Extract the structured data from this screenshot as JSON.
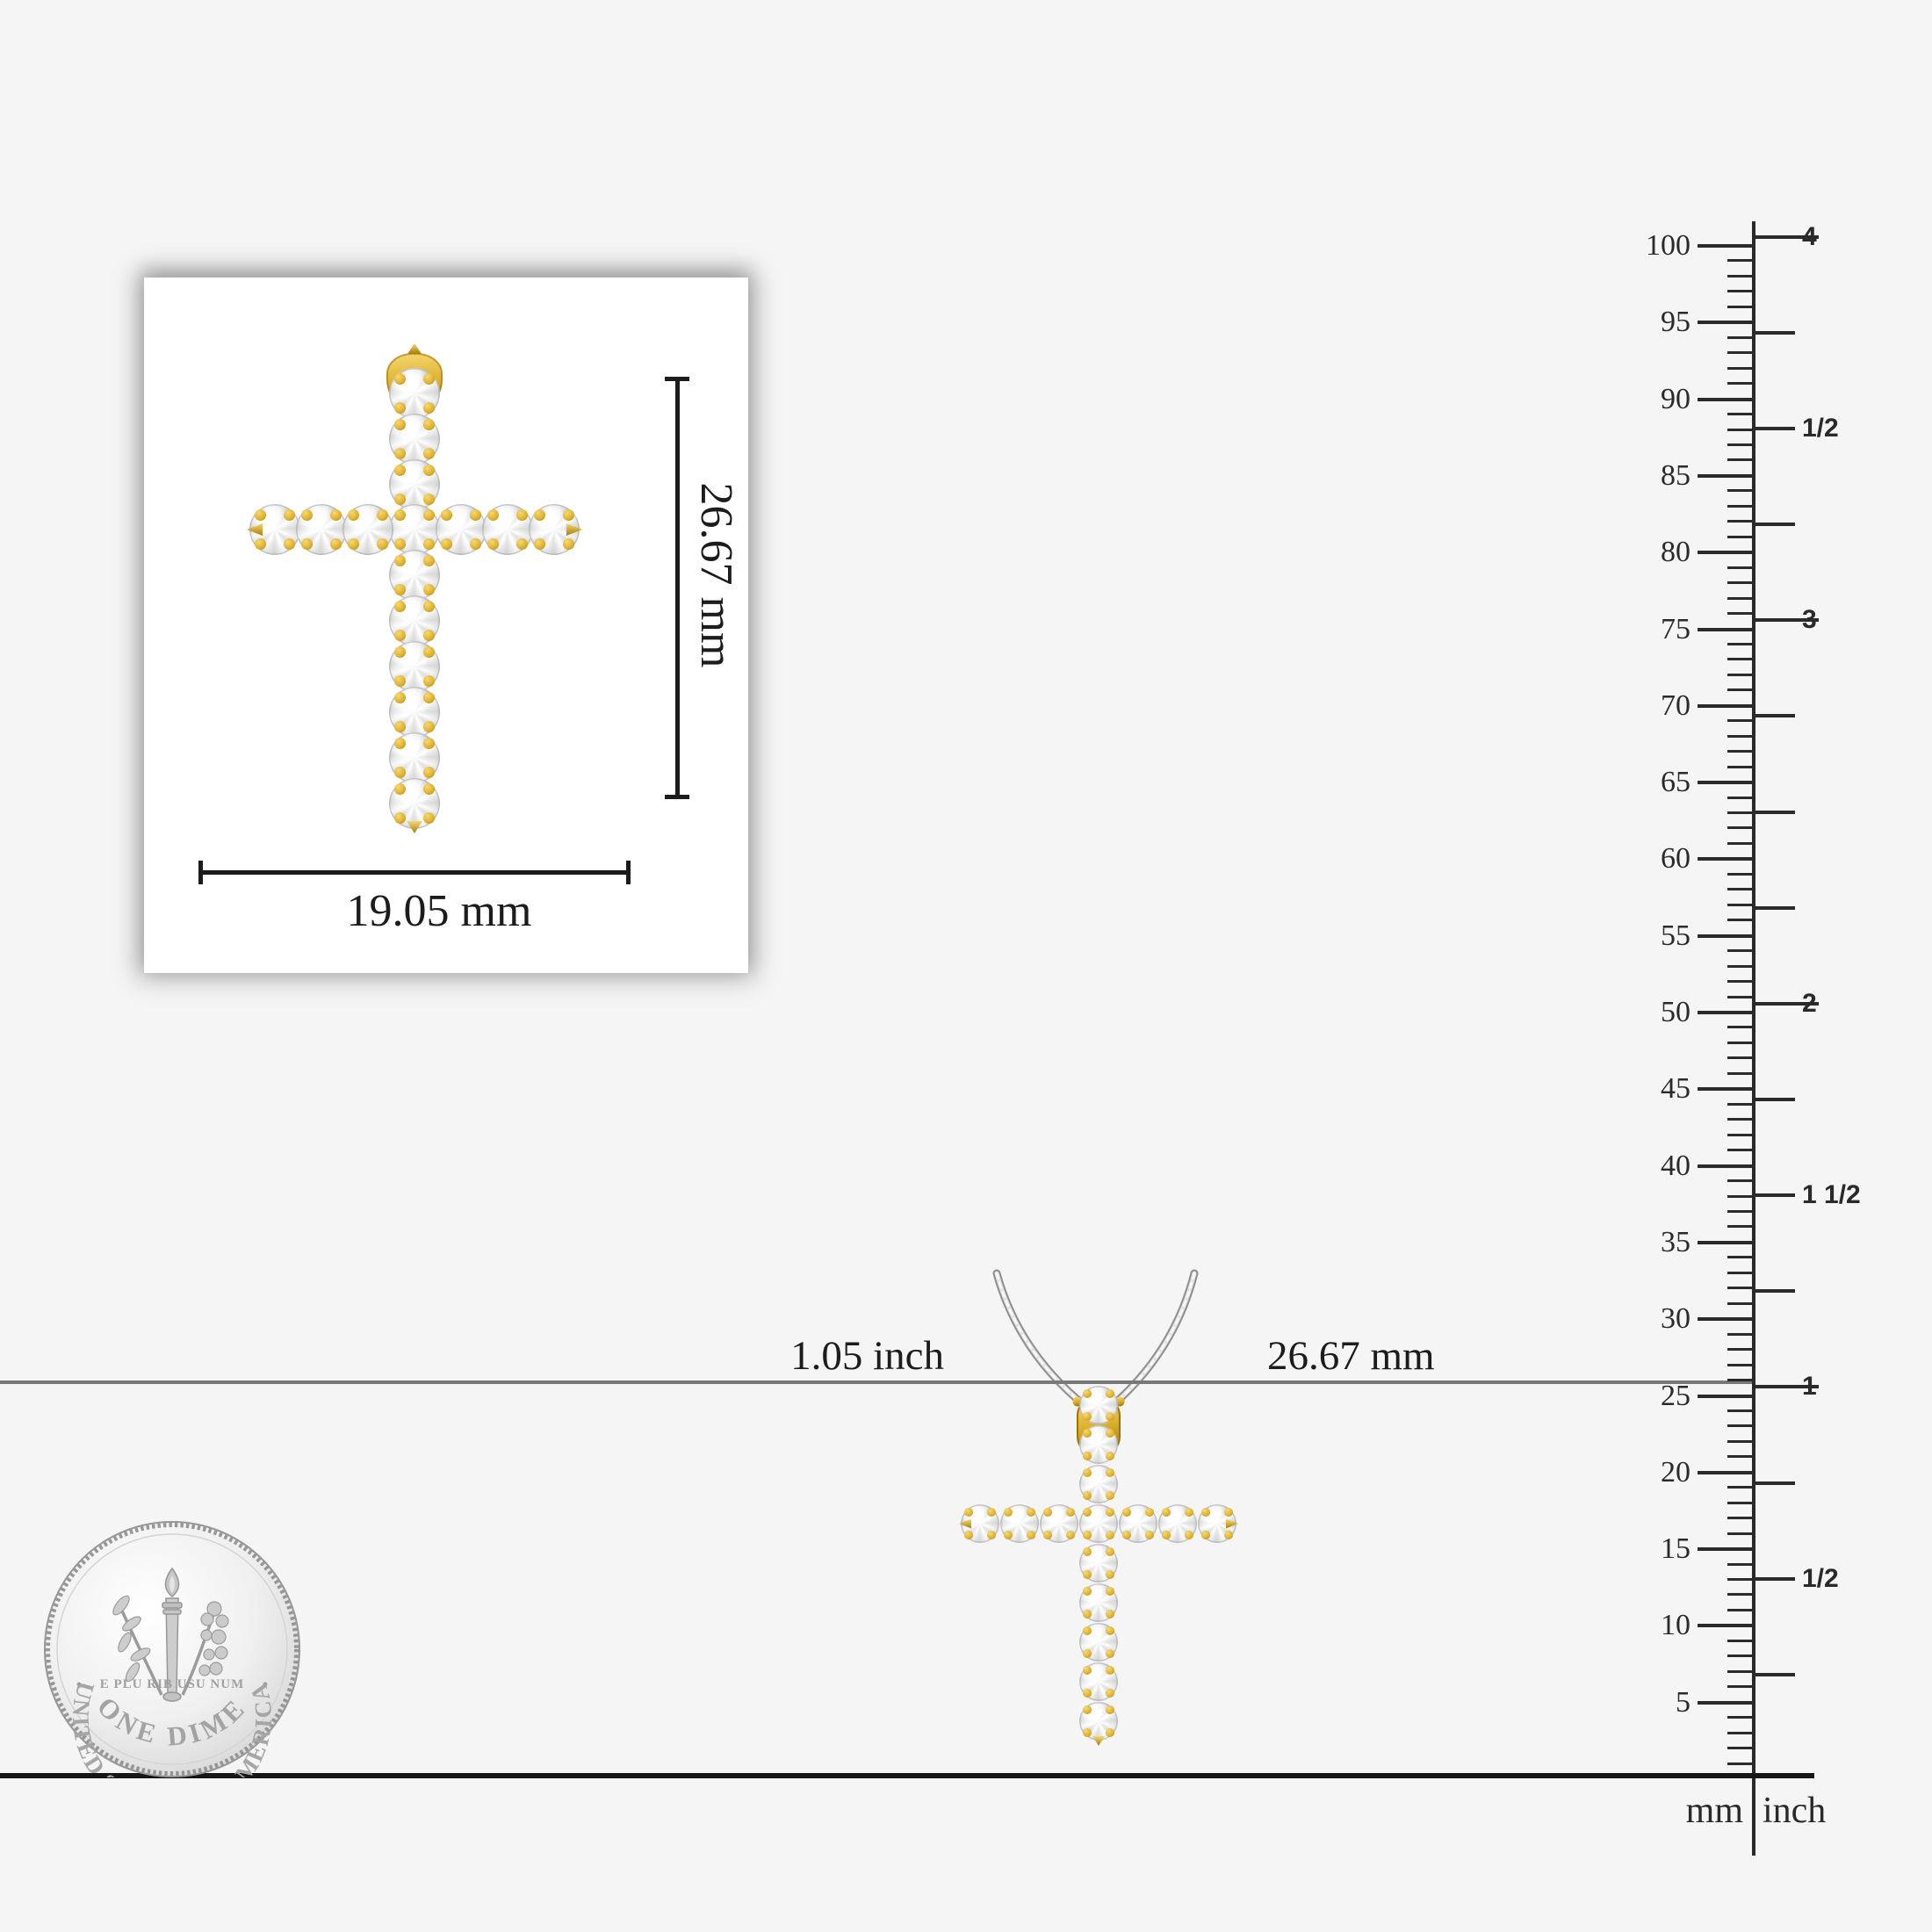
{
  "colors": {
    "background": "#f5f5f5",
    "card": "#ffffff",
    "gold": "#ddb12e",
    "gold_light": "#f6d873",
    "gold_dark": "#a87d08",
    "silver_chain": "#9a9a9a",
    "ink": "#1c1c1c",
    "mid_line": "#787878",
    "ruler_ink": "#2a2a2a"
  },
  "card": {
    "height_label": "26.67 mm",
    "width_label": "19.05 mm"
  },
  "scale_line": {
    "left_label": "1.05 inch",
    "right_label": "26.67 mm"
  },
  "ruler": {
    "unit_left": "mm",
    "unit_right": "inch",
    "mm_major_values": [
      100,
      95,
      90,
      85,
      80,
      75,
      70,
      65,
      60,
      55,
      50,
      45,
      40,
      35,
      30,
      25,
      20,
      15,
      10,
      5
    ],
    "inch_marks": [
      {
        "value": 4,
        "label": "4"
      },
      {
        "value": 3.75,
        "label": ""
      },
      {
        "value": 3.5,
        "label": "1/2"
      },
      {
        "value": 3.25,
        "label": ""
      },
      {
        "value": 3,
        "label": "3"
      },
      {
        "value": 2.75,
        "label": ""
      },
      {
        "value": 2.5,
        "label": ""
      },
      {
        "value": 2.25,
        "label": ""
      },
      {
        "value": 2,
        "label": "2"
      },
      {
        "value": 1.75,
        "label": ""
      },
      {
        "value": 1.5,
        "label": "1 1/2"
      },
      {
        "value": 1.25,
        "label": ""
      },
      {
        "value": 1,
        "label": "1"
      },
      {
        "value": 0.75,
        "label": ""
      },
      {
        "value": 0.5,
        "label": "1/2"
      },
      {
        "value": 0.25,
        "label": ""
      }
    ]
  },
  "coin": {
    "top_text": "UNITED STATES OF AMERICA",
    "middle_text": "E PLU RIB USU NUM",
    "bottom_text": "ONE DIME"
  }
}
